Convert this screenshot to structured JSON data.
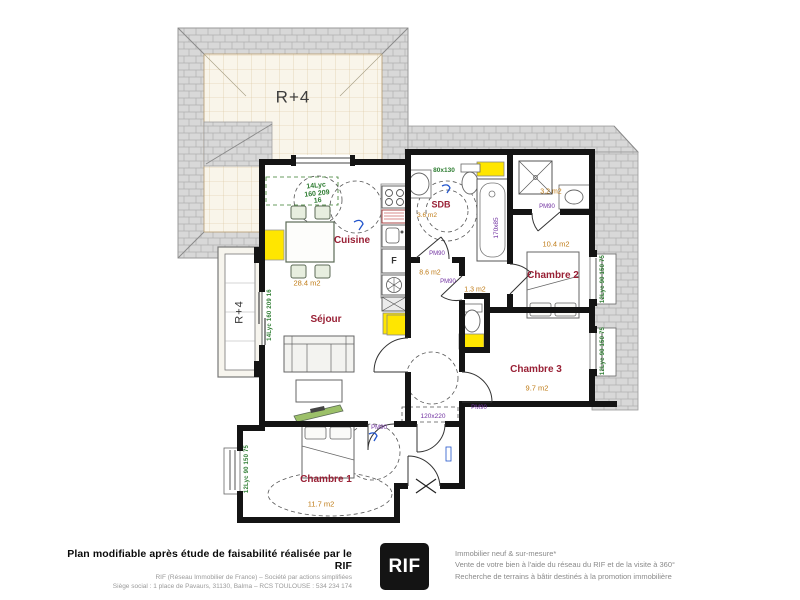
{
  "colors": {
    "wall": "#141414",
    "roof_gray": "#d7d7d7",
    "accent_yellow": "#ffe600",
    "room_label_red": "#992035",
    "area_label_orange": "#bf7b16",
    "window_label_green": "#2e7d32",
    "dimension_purple": "#7030a0",
    "mark_blue": "#2255cc"
  },
  "plan": {
    "roof_label": "R+4",
    "balcony_label": "R+4",
    "rooms": {
      "cuisine": {
        "name": "Cuisine"
      },
      "sejour": {
        "name": "Séjour",
        "area": "28.4 m2"
      },
      "chambre1": {
        "name": "Chambre 1",
        "area": "11.7 m2"
      },
      "chambre2": {
        "name": "Chambre 2",
        "area": "10.4 m2"
      },
      "chambre3": {
        "name": "Chambre 3",
        "area": "9.7 m2"
      },
      "sdb": {
        "name": "SDB",
        "area": "3.6 m2"
      },
      "salle_eau": {
        "area": "3.2 m2"
      },
      "wc": {
        "area": "1.3 m2"
      },
      "degagement": {
        "area": "8.6 m2"
      }
    },
    "labels": {
      "fridge": "F",
      "dim_sanitaire": "80x130",
      "dim_bathtub": "170x85",
      "dim_closet": "120x220",
      "door_tag": "PM90",
      "win_kitchen_1": "14Lyc",
      "win_kitchen_2": "160 209",
      "win_kitchen_3": "16",
      "win_balcony": "14Lyc 160 209 16",
      "win_side": "12Lyc 90 150 75"
    }
  },
  "footer": {
    "title": "Plan modifiable après étude de faisabilité réalisée par le RIF",
    "line1": "RIF (Réseau Immobilier de France)  –  Société par actions simplifiées",
    "line2": "Siège social : 1 place de Pavaurs, 31130, Balma – RCS TOULOUSE : 534 234 174",
    "logo": "RIF",
    "right1": "Immobilier neuf & sur-mesure*",
    "right2": "Vente de votre bien à l'aide du réseau du RIF et de la visite à 360°",
    "right3": "Recherche de terrains à bâtir destinés à la promotion immobilière"
  }
}
